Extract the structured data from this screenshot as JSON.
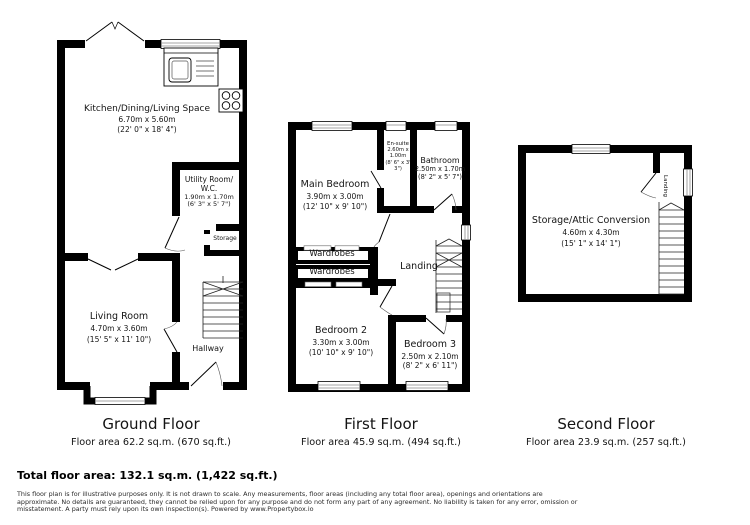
{
  "colors": {
    "wall": "#000000",
    "background": "#ffffff"
  },
  "floors": [
    {
      "title": "Ground Floor",
      "area": "Floor area 62.2 sq.m. (670 sq.ft.)",
      "rooms": {
        "kitchen": {
          "name": "Kitchen/Dining/Living Space",
          "metric": "6.70m x 5.60m",
          "imperial": "(22' 0\" x 18' 4\")"
        },
        "utility": {
          "name": "Utility Room/",
          "name2": "W.C.",
          "metric": "1.90m x 1.70m",
          "imperial": "(6' 3\" x 5' 7\")"
        },
        "storage": {
          "name": "Storage"
        },
        "living": {
          "name": "Living Room",
          "metric": "4.70m x 3.60m",
          "imperial": "(15' 5\" x 11' 10\")"
        },
        "hallway": {
          "name": "Hallway"
        }
      }
    },
    {
      "title": "First Floor",
      "area": "Floor area 45.9 sq.m. (494 sq.ft.)",
      "rooms": {
        "main_bedroom": {
          "name": "Main Bedroom",
          "metric": "3.90m x 3.00m",
          "imperial": "(12' 10\" x 9' 10\")"
        },
        "ensuite": {
          "name": "En-suite",
          "metric": "2.60m x 1.00m",
          "imperial": "(8' 6\" x 3' 3\")"
        },
        "bathroom": {
          "name": "Bathroom",
          "metric": "2.50m x 1.70m",
          "imperial": "(8' 2\" x 5' 7\")"
        },
        "wardrobes1": {
          "name": "Wardrobes"
        },
        "wardrobes2": {
          "name": "Wardrobes"
        },
        "landing": {
          "name": "Landing"
        },
        "bedroom2": {
          "name": "Bedroom 2",
          "metric": "3.30m x 3.00m",
          "imperial": "(10' 10\" x 9' 10\")"
        },
        "bedroom3": {
          "name": "Bedroom 3",
          "metric": "2.50m x 2.10m",
          "imperial": "(8' 2\" x 6' 11\")"
        }
      }
    },
    {
      "title": "Second Floor",
      "area": "Floor area 23.9 sq.m. (257 sq.ft.)",
      "rooms": {
        "attic": {
          "name": "Storage/Attic Conversion",
          "metric": "4.60m x 4.30m",
          "imperial": "(15' 1\" x 14' 1\")"
        },
        "landing": {
          "name": "Landing"
        }
      }
    }
  ],
  "summary": {
    "total": "Total floor area: 132.1 sq.m. (1,422 sq.ft.)"
  },
  "disclaimer": {
    "line1": "This floor plan is for illustrative purposes only. It is not drawn to scale. Any measurements, floor areas (including any total floor area), openings and orientations are",
    "line2": "approximate. No details are guaranteed, they cannot be relied upon for any purpose and do not form any part of any agreement. No liability is taken for any error, omission or",
    "line3": "misstatement. A party must rely upon its own inspection(s). Powered by www.Propertybox.io"
  }
}
